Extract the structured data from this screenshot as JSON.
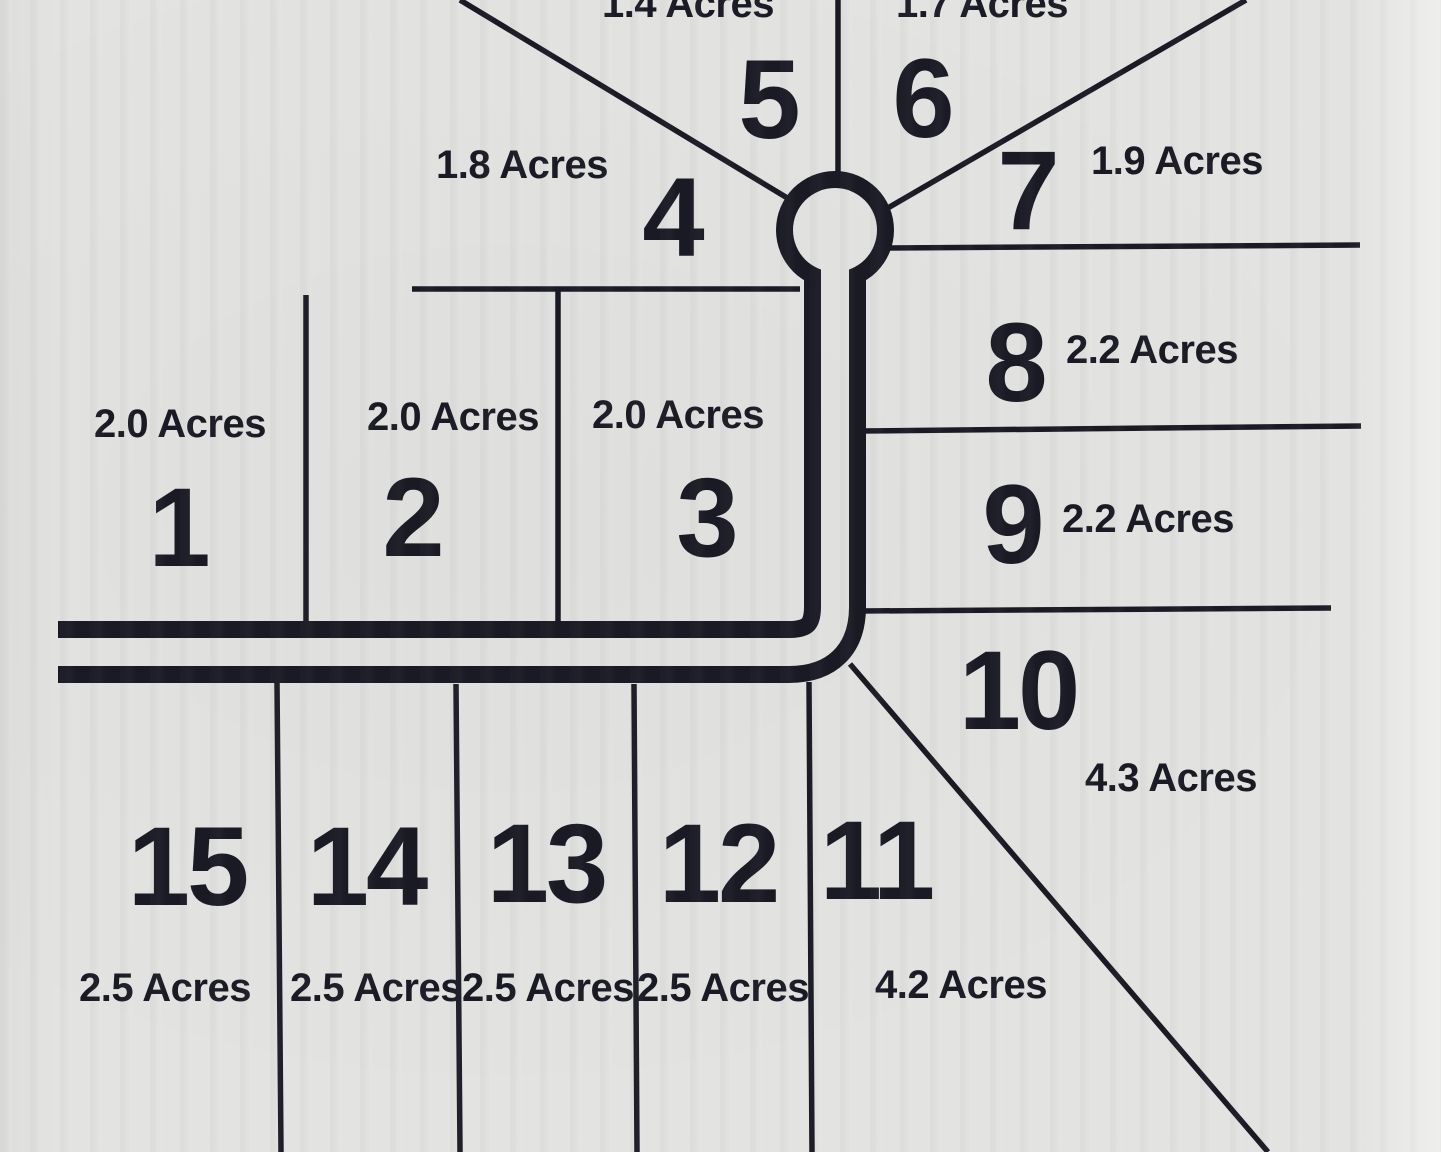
{
  "map": {
    "type_label": "residential lot plat map",
    "ink_color": "#1a1a24",
    "background_color": "#e3e3e1"
  },
  "lots": [
    {
      "number": "1",
      "acreage": "2.0 Acres",
      "num_x": 178,
      "num_y": 528,
      "label_x": 180,
      "label_y": 424
    },
    {
      "number": "2",
      "acreage": "2.0 Acres",
      "num_x": 412,
      "num_y": 518,
      "label_x": 453,
      "label_y": 417
    },
    {
      "number": "3",
      "acreage": "2.0 Acres",
      "num_x": 706,
      "num_y": 518,
      "label_x": 678,
      "label_y": 415
    },
    {
      "number": "4",
      "acreage": "1.8 Acres",
      "num_x": 672,
      "num_y": 218,
      "label_x": 522,
      "label_y": 165
    },
    {
      "number": "5",
      "acreage": "1.4 Acres",
      "num_x": 768,
      "num_y": 100,
      "label_x": 688,
      "label_y": 4
    },
    {
      "number": "6",
      "acreage": "1.7 Acres",
      "num_x": 922,
      "num_y": 99,
      "label_x": 982,
      "label_y": 4
    },
    {
      "number": "7",
      "acreage": "1.9 Acres",
      "num_x": 1027,
      "num_y": 191,
      "label_x": 1177,
      "label_y": 161
    },
    {
      "number": "8",
      "acreage": "2.2 Acres",
      "num_x": 1015,
      "num_y": 363,
      "label_x": 1152,
      "label_y": 350
    },
    {
      "number": "9",
      "acreage": "2.2 Acres",
      "num_x": 1012,
      "num_y": 525,
      "label_x": 1148,
      "label_y": 519
    },
    {
      "number": "10",
      "acreage": "4.3 Acres",
      "num_x": 1018,
      "num_y": 691,
      "label_x": 1171,
      "label_y": 778
    },
    {
      "number": "11",
      "acreage": "4.2 Acres",
      "num_x": 876,
      "num_y": 861,
      "label_x": 961,
      "label_y": 985
    },
    {
      "number": "12",
      "acreage": "2.5 Acres",
      "num_x": 718,
      "num_y": 864,
      "label_x": 723,
      "label_y": 988
    },
    {
      "number": "13",
      "acreage": "2.5 Acres",
      "num_x": 546,
      "num_y": 864,
      "label_x": 548,
      "label_y": 988
    },
    {
      "number": "14",
      "acreage": "2.5 Acres",
      "num_x": 366,
      "num_y": 867,
      "label_x": 376,
      "label_y": 988
    },
    {
      "number": "15",
      "acreage": "2.5 Acres",
      "num_x": 187,
      "num_y": 867,
      "label_x": 165,
      "label_y": 988
    }
  ]
}
